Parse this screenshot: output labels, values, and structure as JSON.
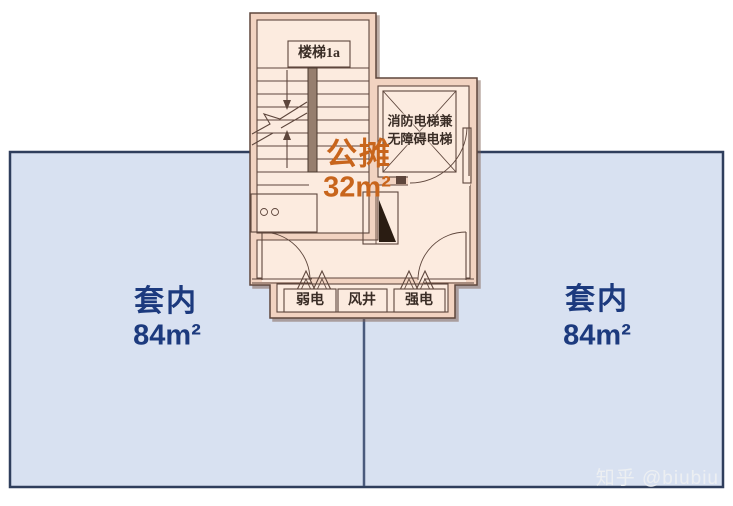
{
  "regions": {
    "common": {
      "name": "公摊",
      "area": "32m²"
    },
    "left_unit": {
      "name": "套内",
      "area": "84m²"
    },
    "right_unit": {
      "name": "套内",
      "area": "84m²"
    }
  },
  "plan_labels": {
    "stairwell": "楼梯1a",
    "elevator_line1": "消防电梯兼",
    "elevator_line2": "无障碍电梯",
    "weak_power_shaft": "弱电",
    "air_shaft": "风井",
    "strong_power_shaft": "强电"
  },
  "watermark": "知乎 @biubiu",
  "colors": {
    "unit_fill": "#d8e1f1",
    "unit_border": "#2f3e5c",
    "divider": "#4a5a7c",
    "plan_fill": "#fcebdf",
    "wall_fill": "#f2d3c1",
    "wall_line": "#5e463c",
    "common_text": "#c8651c",
    "unit_text": "#1c3a7e",
    "label_text": "#3a2d26",
    "watermark_text": "#eef0f3"
  }
}
